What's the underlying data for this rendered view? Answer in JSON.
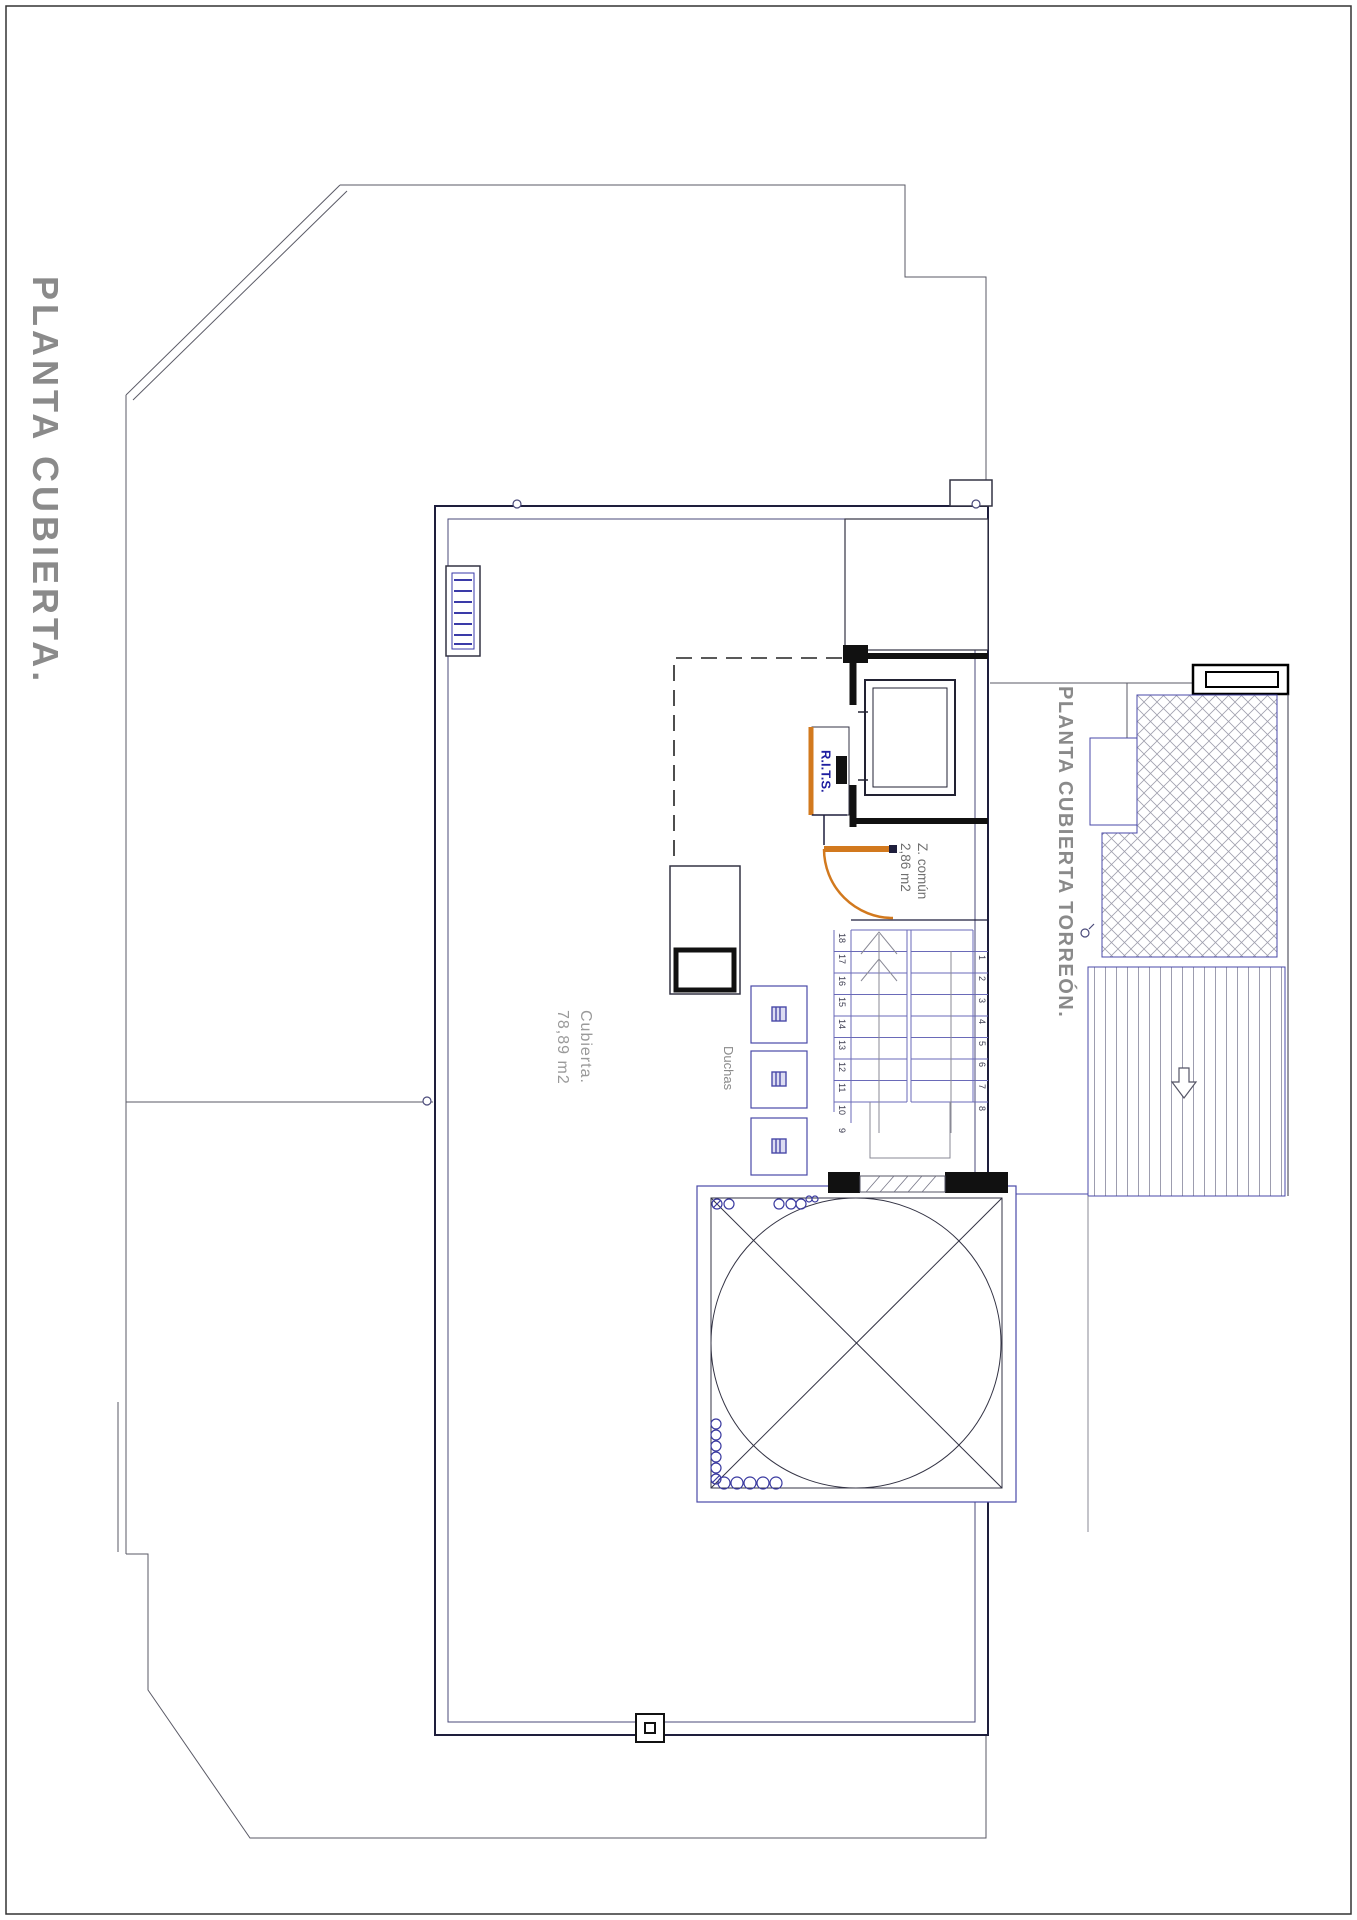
{
  "titles": {
    "main": "PLANTA CUBIERTA.",
    "torreon": "PLANTA CUBIERTA TORREÓN."
  },
  "labels": {
    "rits": "R.I.T.S.",
    "zona_comun_name": "Z. común",
    "zona_comun_area": "2,86 m2",
    "cubierta_name": "Cubierta.",
    "cubierta_area": "78,89 m2",
    "duchas": "Duchas"
  },
  "stairs": {
    "left_numbers": [
      "18",
      "17",
      "16",
      "15",
      "14",
      "13",
      "12",
      "11",
      "10",
      "9"
    ],
    "right_numbers": [
      "1",
      "2",
      "3",
      "4",
      "5",
      "6",
      "7",
      "8"
    ]
  },
  "colors": {
    "accent_orange": "#d2791e",
    "plan_blue": "#3a3aa8",
    "text_gray": "#8a8a8a",
    "line_dark": "#1e1e3c"
  }
}
